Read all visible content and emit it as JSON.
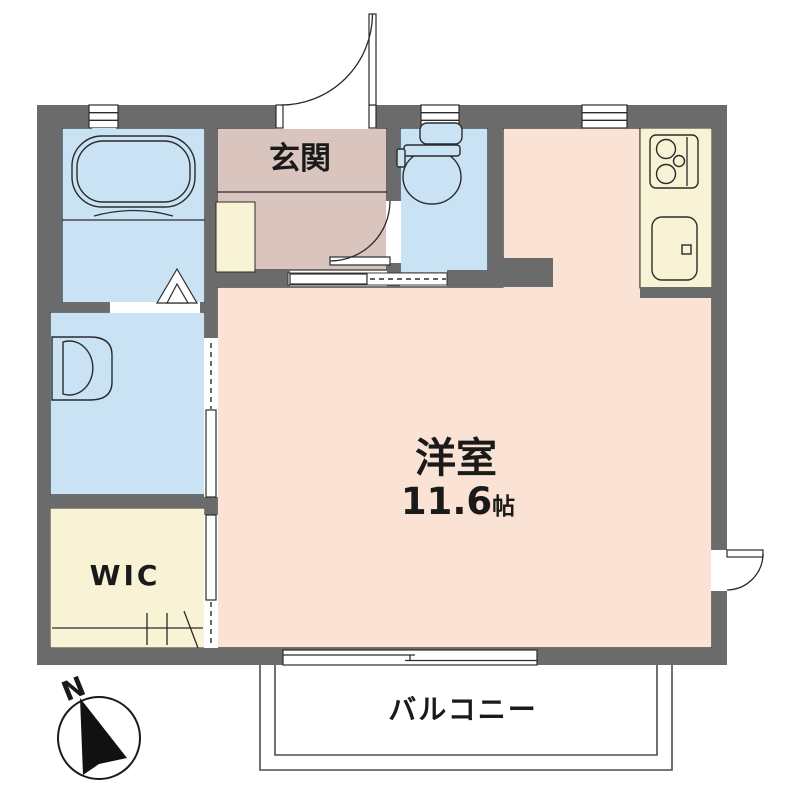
{
  "labels": {
    "entrance": "玄関",
    "main_room": "洋室",
    "main_room_size": "11.6",
    "main_room_size_unit": "帖",
    "wic": "WIC",
    "balcony": "バルコニー",
    "compass_north": "N"
  },
  "colors": {
    "wall": "#6b6b6b",
    "water_rooms": "#c9e3f4",
    "entrance_floor": "#d9c4be",
    "main_room_floor": "#fae3d4",
    "storage_kitchen_floor": "#f7f3d4",
    "line": "#2b2b2b",
    "background": "#ffffff"
  },
  "icons": {
    "fixtures": [
      "bathtub-icon",
      "washbasin-icon",
      "toilet-icon",
      "stove-icon",
      "kitchen-sink-icon",
      "shoe-cabinet-icon",
      "closet-rail-icon"
    ],
    "architecture": [
      "swing-door-icon",
      "folding-door-icon",
      "sliding-door-icon",
      "window-icon",
      "balcony-rail",
      "compass-icon"
    ]
  }
}
